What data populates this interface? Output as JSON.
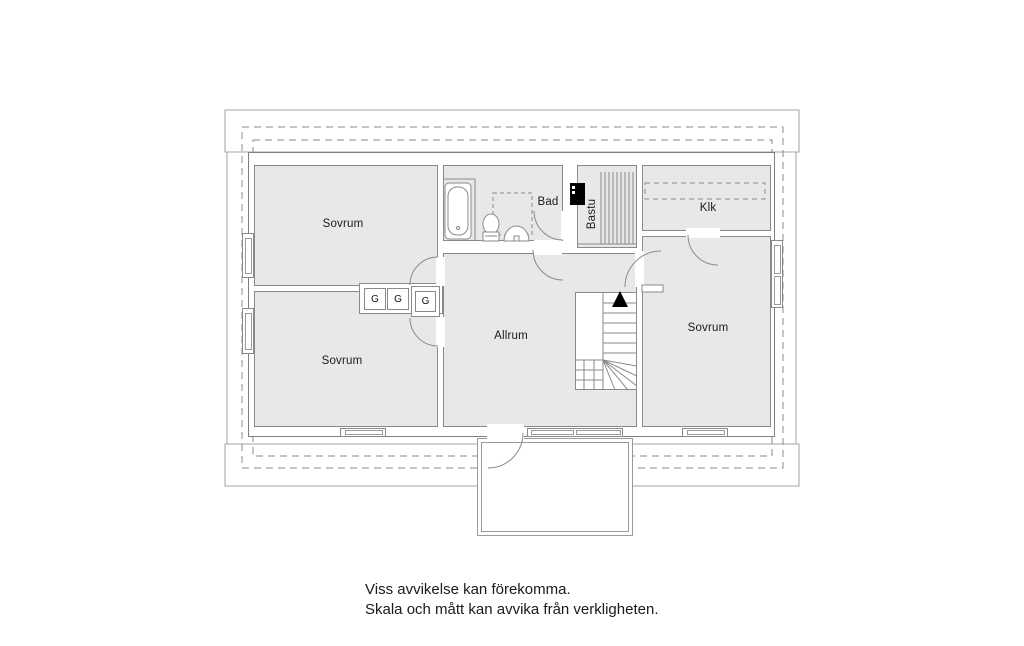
{
  "floorplan": {
    "title": "floor-plan-upper-storey",
    "rooms": {
      "sovrum_top_left": {
        "label": "Sovrum"
      },
      "sovrum_bottom_left": {
        "label": "Sovrum"
      },
      "sovrum_right": {
        "label": "Sovrum"
      },
      "allrum": {
        "label": "Allrum"
      },
      "bad": {
        "label": "Bad"
      },
      "bastu": {
        "label": "Bastu"
      },
      "klk": {
        "label": "Klk"
      }
    },
    "closets": [
      {
        "label": "G"
      },
      {
        "label": "G"
      },
      {
        "label": "G"
      }
    ],
    "stairs": {
      "direction_arrow": "up"
    },
    "disclaimer": {
      "line1": "Viss avvikelse kan förekomma.",
      "line2": "Skala och mått kan avvika från verkligheten."
    },
    "colors": {
      "room_fill": "#e8e8e8",
      "wall_line": "#8a8a8a",
      "roof_line": "#a3a3a3",
      "text": "#1a1a1a",
      "sauna_heater": "#000000"
    }
  }
}
